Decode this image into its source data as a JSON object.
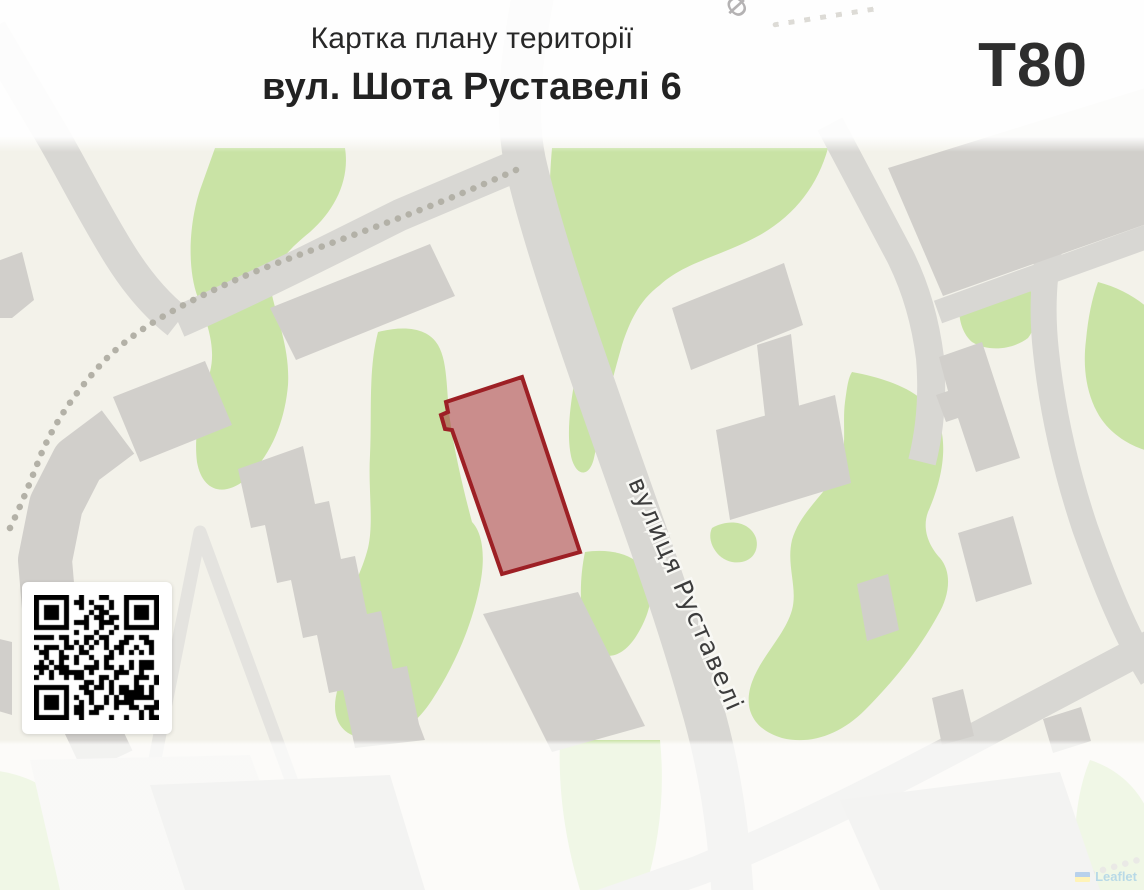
{
  "header": {
    "title_line1": "Картка плану території",
    "title_line2": "вул. Шота Руставелі 6",
    "code": "T80"
  },
  "map": {
    "street_label": "вулиця Руставелі",
    "partial_label": "Ф",
    "highlighted_parcel": {
      "stroke_color": "#9d2025",
      "fill_color": "#9d2025",
      "fill_opacity": 0.48
    },
    "colors": {
      "land": "#f3f2ea",
      "green_area": "#c9e3a5",
      "road": "#d8d7d3",
      "footpath": "#e4e3df",
      "building": "#d1cfcb",
      "dotted_path": "#b3b1a7"
    }
  },
  "qr": {
    "modules": 25,
    "seed": 91,
    "dark_color": "#000000",
    "light_color": "#ffffff"
  },
  "attribution": {
    "text": "Leaflet",
    "flag_blue": "#005BBB",
    "flag_yellow": "#FFD500",
    "link_color": "#0078A8"
  }
}
